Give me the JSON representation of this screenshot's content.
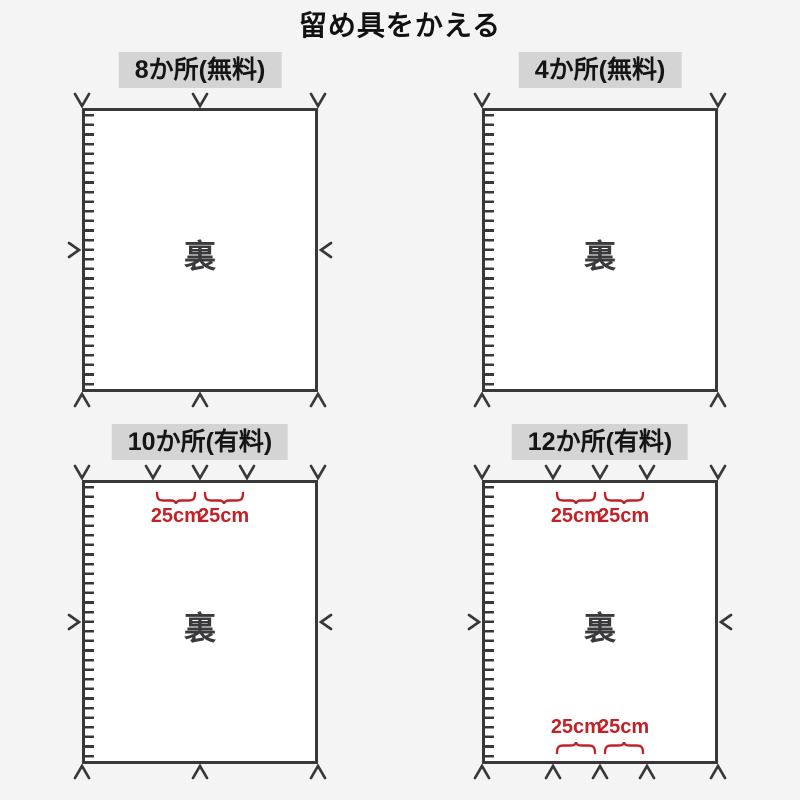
{
  "title": "留め具をかえる",
  "colors": {
    "background": "#f4f4f5",
    "line": "#38383a",
    "label_background": "#d4d4d4",
    "fabric_fill": "#ffffff",
    "accent_red": "#c22127",
    "text": "#111111"
  },
  "panels": [
    {
      "id": "8-places-free",
      "label": "8か所(無料)",
      "center_text": "裏",
      "top_fastener_positions": [
        0,
        0.5,
        1
      ],
      "bottom_fastener_positions": [
        0,
        0.5,
        1
      ],
      "left_fastener": true,
      "right_fastener": true,
      "top_spacing": null,
      "bottom_spacing": null
    },
    {
      "id": "4-places-free",
      "label": "4か所(無料)",
      "center_text": "裏",
      "top_fastener_positions": [
        0,
        1
      ],
      "bottom_fastener_positions": [
        0,
        1
      ],
      "left_fastener": false,
      "right_fastener": false,
      "top_spacing": null,
      "bottom_spacing": null
    },
    {
      "id": "10-places-paid",
      "label": "10か所(有料)",
      "center_text": "裏",
      "top_fastener_positions": [
        0,
        0.3,
        0.5,
        0.7,
        1
      ],
      "bottom_fastener_positions": [
        0,
        0.5,
        1
      ],
      "left_fastener": true,
      "right_fastener": true,
      "top_spacing": {
        "labels": [
          "25cm",
          "25cm"
        ],
        "between": [
          [
            0.3,
            0.5
          ],
          [
            0.5,
            0.7
          ]
        ]
      },
      "bottom_spacing": null
    },
    {
      "id": "12-places-paid",
      "label": "12か所(有料)",
      "center_text": "裏",
      "top_fastener_positions": [
        0,
        0.3,
        0.5,
        0.7,
        1
      ],
      "bottom_fastener_positions": [
        0,
        0.3,
        0.5,
        0.7,
        1
      ],
      "left_fastener": true,
      "right_fastener": true,
      "top_spacing": {
        "labels": [
          "25cm",
          "25cm"
        ],
        "between": [
          [
            0.3,
            0.5
          ],
          [
            0.5,
            0.7
          ]
        ]
      },
      "bottom_spacing": {
        "labels": [
          "25cm",
          "25cm"
        ],
        "between": [
          [
            0.3,
            0.5
          ],
          [
            0.5,
            0.7
          ]
        ]
      }
    }
  ]
}
